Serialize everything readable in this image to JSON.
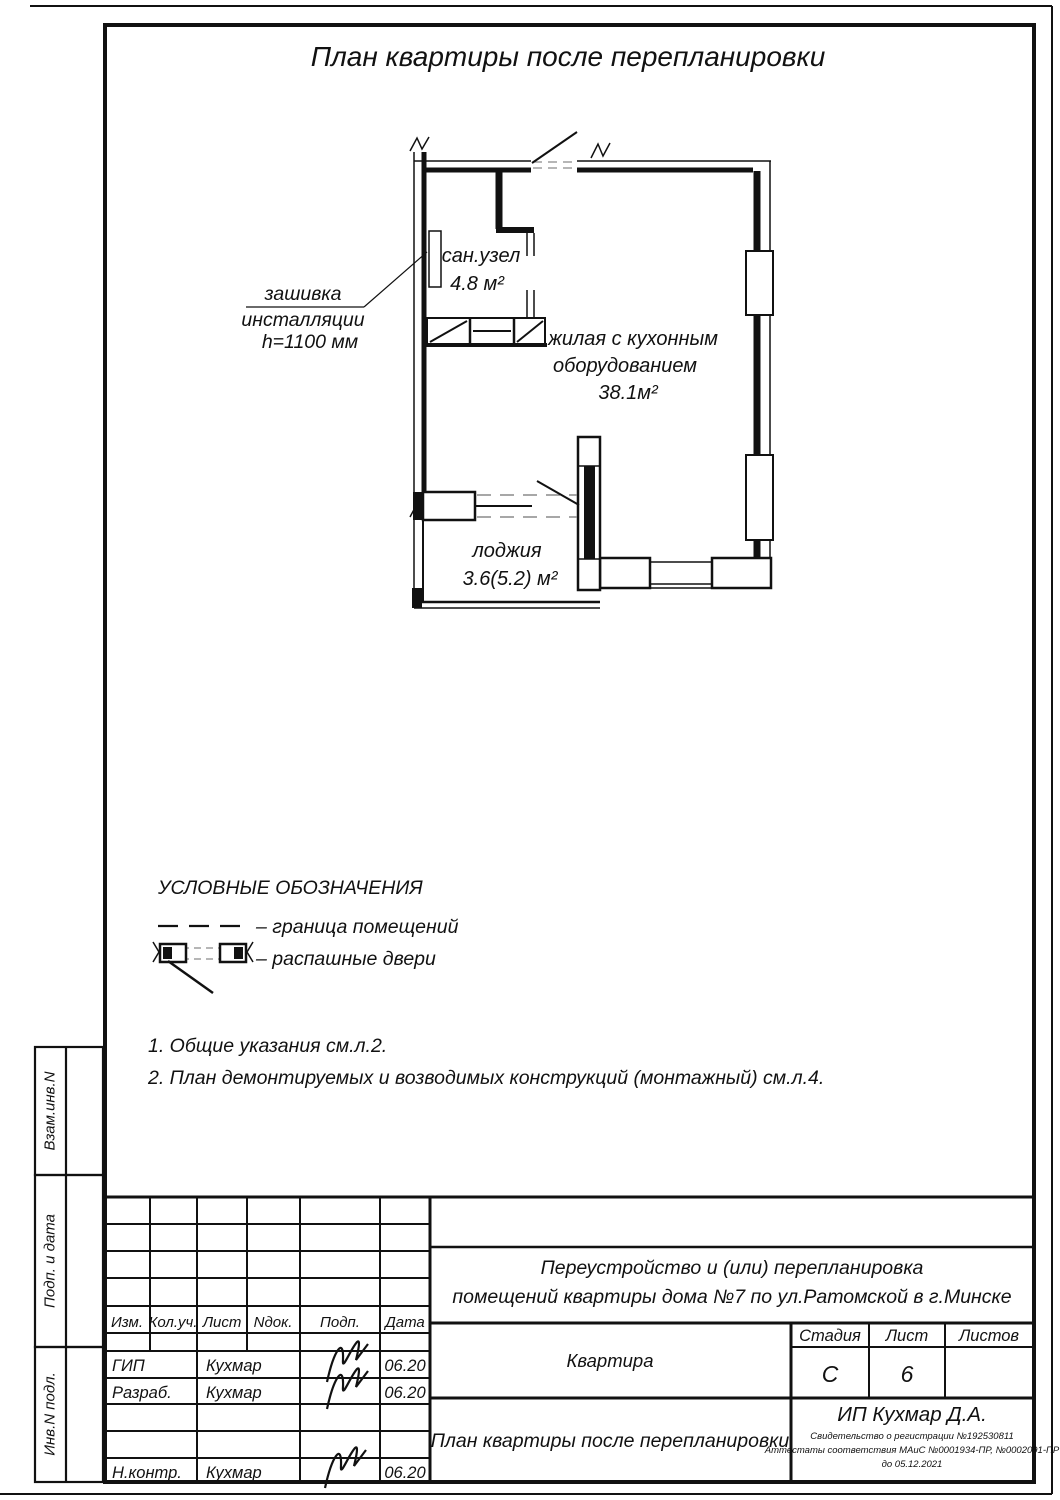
{
  "page_title": "План квартиры после перепланировки",
  "plan": {
    "callout": {
      "line1": "зашивка",
      "line2": "инсталляции",
      "line3": "h=1100 мм"
    },
    "sanuzel": {
      "name": "сан.узел",
      "area": "4.8 м²"
    },
    "living": {
      "line1": "жилая с кухонным",
      "line2": "оборудованием",
      "area": "38.1м²"
    },
    "loggia": {
      "name": "лоджия",
      "area": "3.6(5.2) м²"
    }
  },
  "legend": {
    "title": "УСЛОВНЫЕ ОБОЗНАЧЕНИЯ",
    "item1": "– граница помещений",
    "item2": "– распашные двери"
  },
  "notes": {
    "n1": "1. Общие указания см.л.2.",
    "n2": "2. План демонтируемых и возводимых конструкций (монтажный) см.л.4."
  },
  "sidebar": {
    "box1": "Взам.инв.N",
    "box2": "Подп. и дата",
    "box3": "Инв.N подл."
  },
  "stamp": {
    "cols": {
      "c1": "Изм.",
      "c2": "Кол.уч.",
      "c3": "Лист",
      "c4": "Nдок.",
      "c5": "Подп.",
      "c6": "Дата"
    },
    "rows": {
      "r1": {
        "role": "ГИП",
        "name": "Кухмар",
        "date": "06.20"
      },
      "r2": {
        "role": "Разраб.",
        "name": "Кухмар",
        "date": "06.20"
      },
      "r3": {
        "role": "Н.контр.",
        "name": "Кухмар",
        "date": "06.20"
      }
    },
    "project": {
      "line1": "Переустройство и (или) перепланировка",
      "line2": "помещений квартиры дома №7 по ул.Ратомской в г.Минске"
    },
    "object_name": "Квартира",
    "stage_label": "Стадия",
    "sheet_label": "Лист",
    "sheets_label": "Листов",
    "stage_value": "С",
    "sheet_value": "6",
    "sheet_title": "План квартиры после перепланировки",
    "company": "ИП Кухмар Д.А.",
    "cert1": "Свидетельство о регистрации №192530811",
    "cert2": "Аттестаты соответствия МАиС №0001934-ПР, №0002091-ПР",
    "cert3": "до 05.12.2021"
  }
}
